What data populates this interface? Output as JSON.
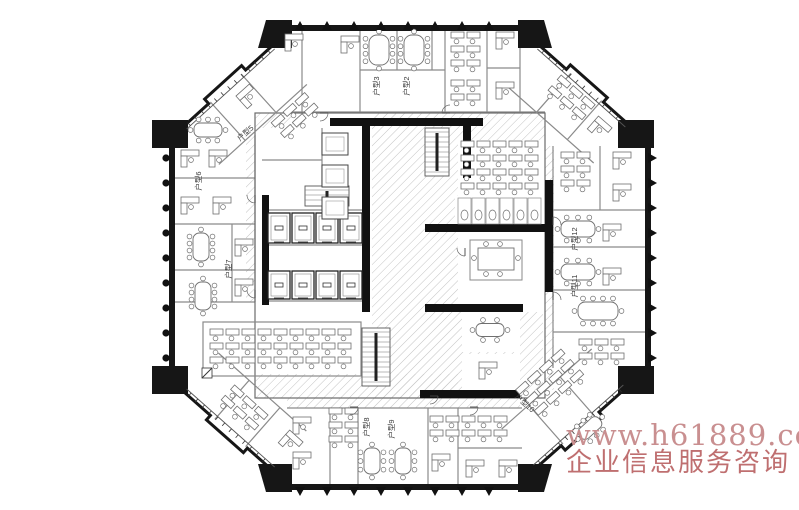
{
  "plan": {
    "colors": {
      "wall": "#161616",
      "partition": "#8a8a8a",
      "furniture": "#6f6f6f",
      "hatch": "#c3c3c3",
      "label": "#3c3c3c"
    },
    "unit_labels": [
      {
        "text": "户型2",
        "x": 409,
        "y": 86,
        "rot": -90
      },
      {
        "text": "户型3",
        "x": 379,
        "y": 86,
        "rot": -90
      },
      {
        "text": "户型5",
        "x": 247,
        "y": 135,
        "rot": -42
      },
      {
        "text": "户型6",
        "x": 201,
        "y": 181,
        "rot": -90
      },
      {
        "text": "户型7",
        "x": 231,
        "y": 269,
        "rot": -90
      },
      {
        "text": "户型8",
        "x": 369,
        "y": 427,
        "rot": -90
      },
      {
        "text": "户型9",
        "x": 394,
        "y": 429,
        "rot": -90
      },
      {
        "text": "户型10",
        "x": 523,
        "y": 405,
        "rot": 42
      },
      {
        "text": "户型11",
        "x": 577,
        "y": 286,
        "rot": -90
      },
      {
        "text": "户型12",
        "x": 577,
        "y": 239,
        "rot": -90
      }
    ]
  },
  "watermark": {
    "url_text": "www.h61889.com",
    "caption": "企业信息服务咨询",
    "url_color": "#c98f90",
    "caption_color": "#bf6f70"
  }
}
